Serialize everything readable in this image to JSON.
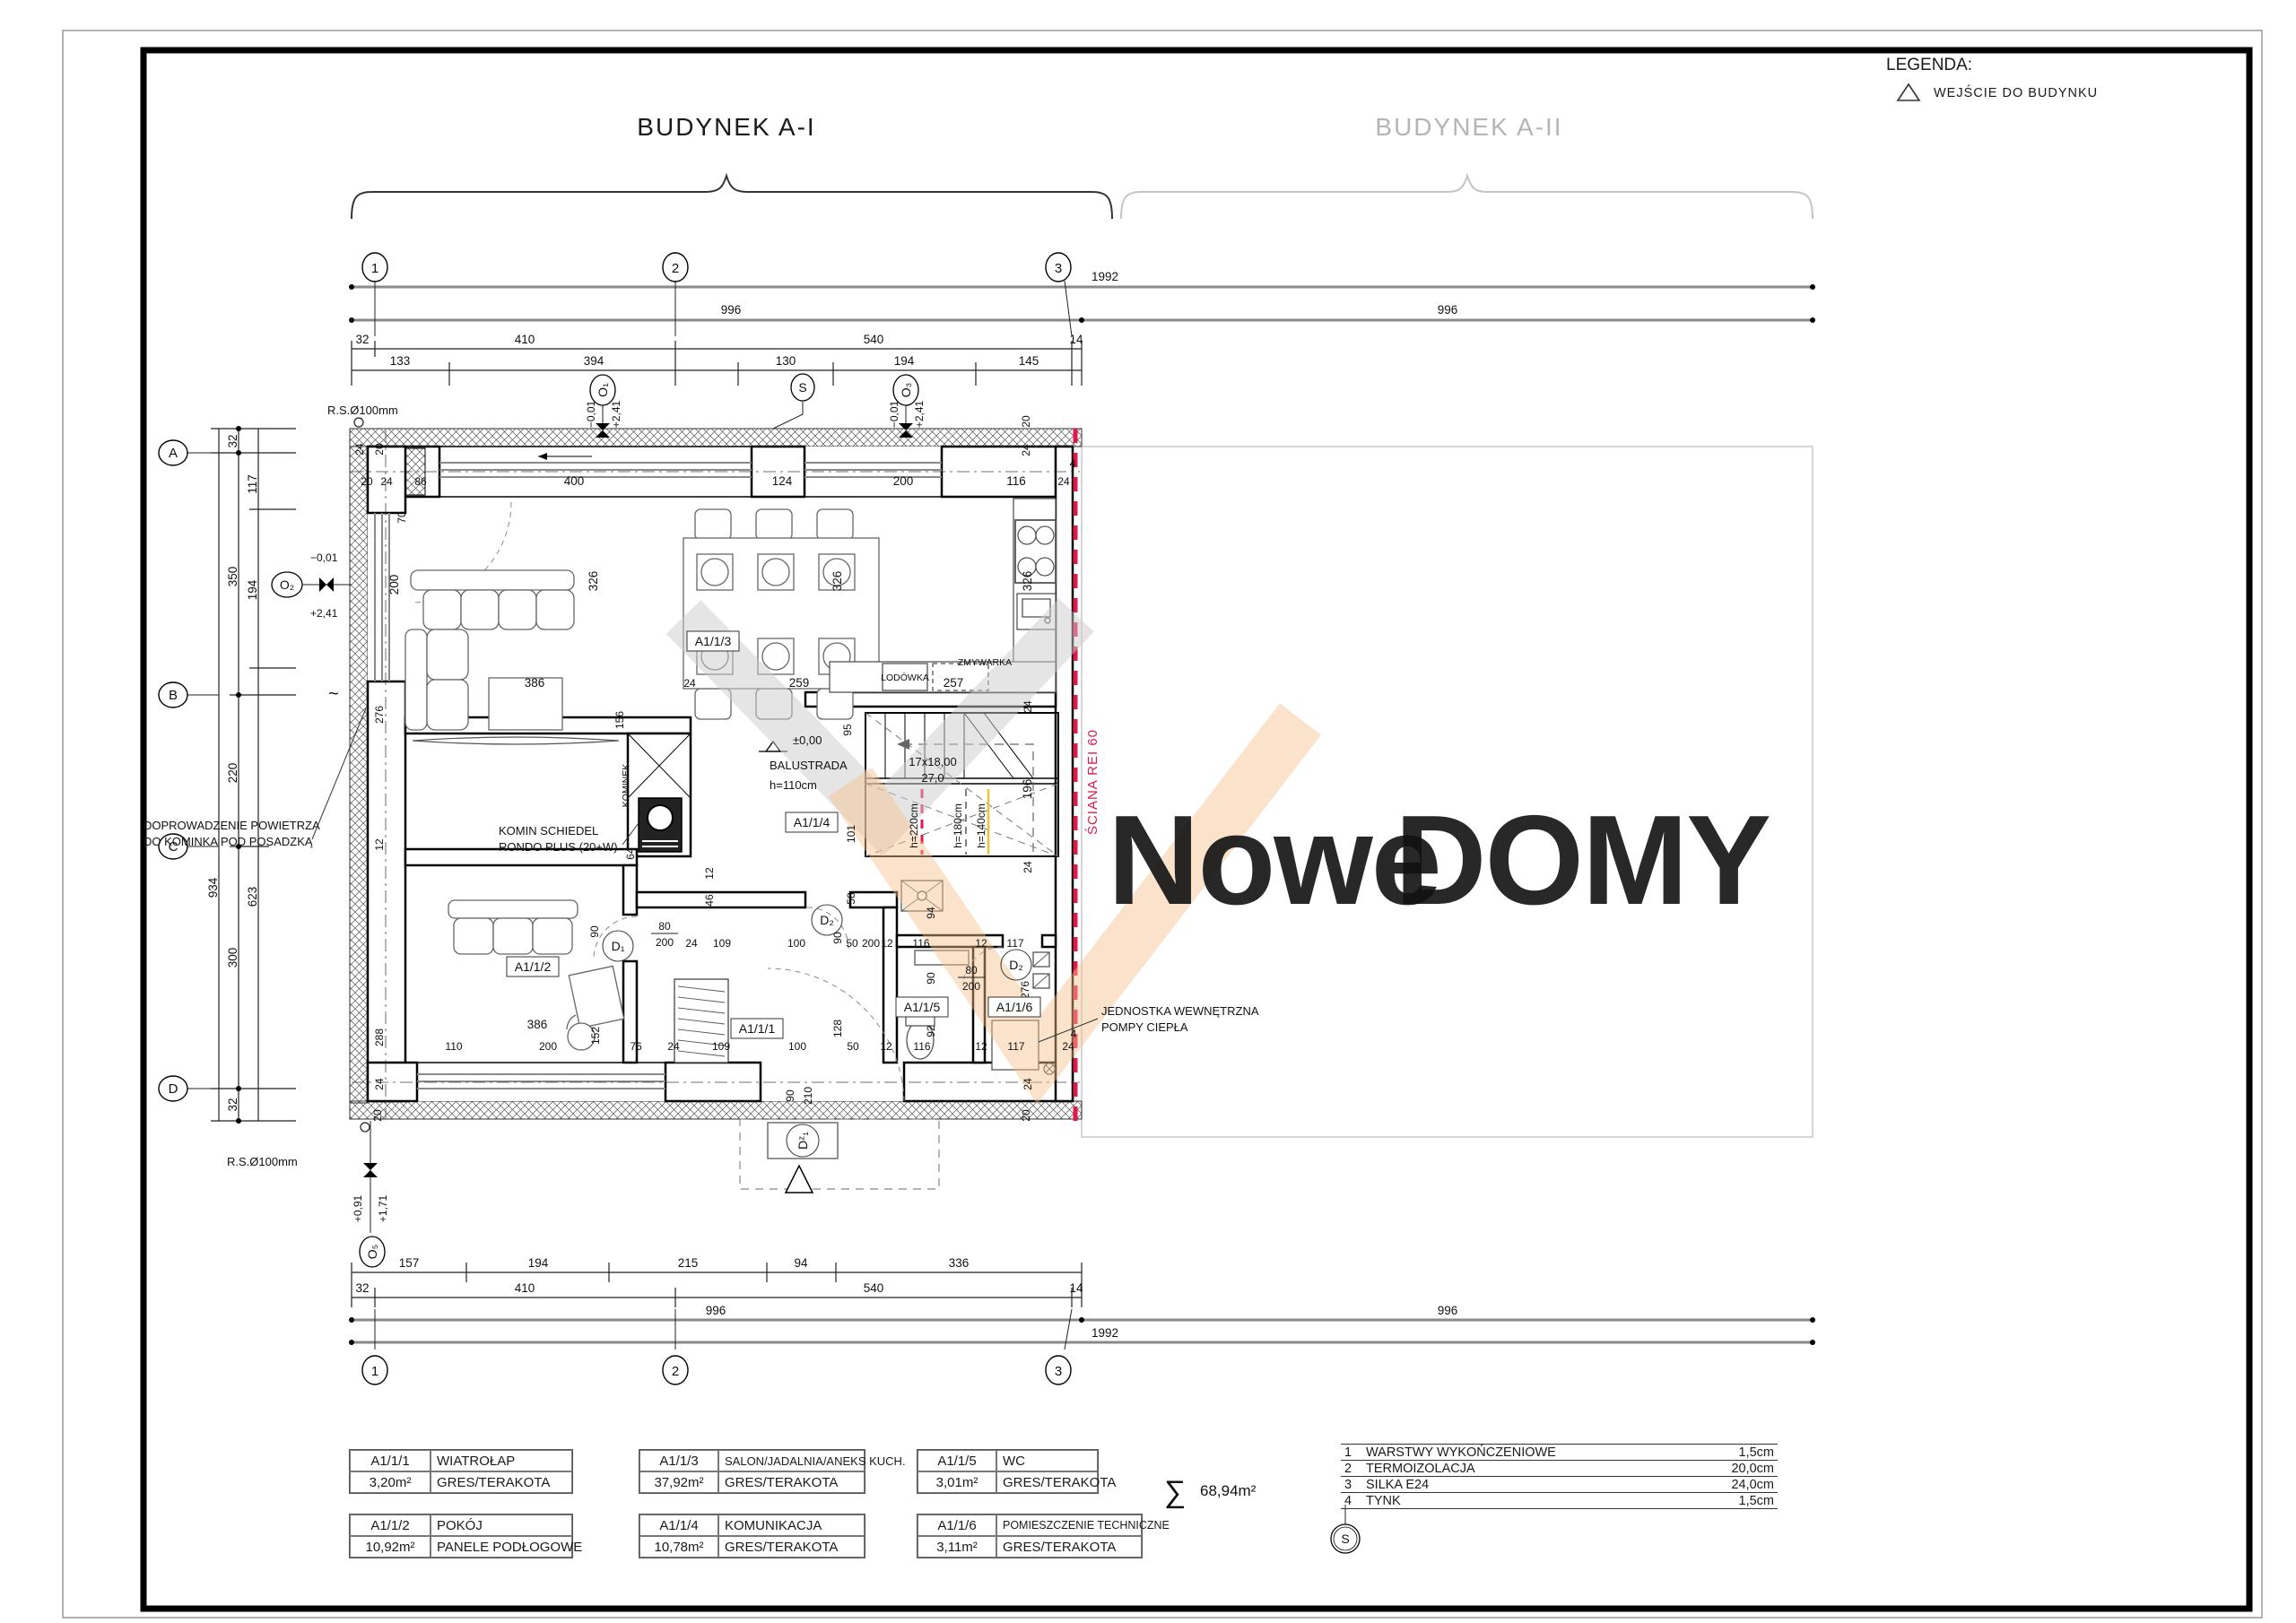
{
  "titles": {
    "left": "BUDYNEK A-I",
    "right": "BUDYNEK A-II"
  },
  "legend": {
    "title": "LEGENDA:",
    "entry": "WEJŚCIE DO BUDYNKU"
  },
  "watermark": {
    "gray": "Nowe",
    "orange": "DOMY"
  },
  "axes": {
    "c1": "1",
    "c2": "2",
    "c3": "3",
    "rA": "A",
    "rB": "B",
    "rC": "C",
    "rD": "D"
  },
  "dims": {
    "top": {
      "total": "1992",
      "left996": "996",
      "right996": "996",
      "r2": [
        "32",
        "410",
        "540",
        "14"
      ],
      "r3": [
        "133",
        "394",
        "130",
        "194",
        "145"
      ]
    },
    "bottom": {
      "r1": [
        "157",
        "194",
        "215",
        "94",
        "336"
      ],
      "r2": [
        "32",
        "410",
        "540",
        "14"
      ],
      "left996": "996",
      "right996": "996",
      "total": "1992"
    },
    "left": {
      "total": "934",
      "outer": [
        "32",
        "350",
        "220",
        "300",
        "32"
      ],
      "inner": [
        "117",
        "194",
        "623"
      ]
    },
    "sd": [
      "20",
      "24",
      "86",
      "70",
      "400",
      "124",
      "200",
      "116",
      "24",
      "4",
      "20",
      "24",
      "200",
      "326",
      "326",
      "326",
      "386",
      "24",
      "259",
      "257",
      "276",
      "156",
      "12",
      "64",
      "95",
      "101",
      "58",
      "24",
      "196",
      "24",
      "12",
      "46",
      "90",
      "80",
      "200",
      "24",
      "109",
      "100",
      "90",
      "50",
      "200",
      "12",
      "116",
      "12",
      "117",
      "94",
      "80",
      "200",
      "90",
      "276",
      "128",
      "92",
      "288",
      "386",
      "152",
      "110",
      "200",
      "76",
      "24",
      "109",
      "100",
      "50",
      "12",
      "116",
      "12",
      "117",
      "4",
      "24",
      "90",
      "210",
      "24",
      "20",
      "24",
      "20",
      "20",
      "24"
    ]
  },
  "markers": {
    "o1": "O₁",
    "o2": "O₂",
    "o3": "O₃",
    "o5": "O₅",
    "s": "S",
    "d1": "D₁",
    "d2": "D₂",
    "dz1": "Dᶻ₁"
  },
  "levels": {
    "m001": "−0,01",
    "p241": "+2,41",
    "p091": "+0,91",
    "p171": "+1,71",
    "zero": "±0,00"
  },
  "notes": {
    "rs": "R.S.Ø100mm",
    "komin1": "KOMIN SCHIEDEL",
    "komin2": "RONDO PLUS (20+W)",
    "kominek": "KOMINEK",
    "balustrada": "BALUSTRADA",
    "balustrada_h": "h=110cm",
    "stairs1": "17x18,00",
    "stairs2": "27,0",
    "h220": "h=220cm",
    "h180": "h=180cm",
    "h140": "h=140cm",
    "sciana": "ŚCIANA REI 60",
    "jednostka1": "JEDNOSTKA WEWNĘTRZNA",
    "jednostka2": "POMPY CIEPŁA",
    "dopr1": "DOPROWADZENIE POWIETRZA",
    "dopr2": "DO KOMINKA POD POSADZKĄ",
    "lodowka": "LODÓWKA",
    "zmywarka": "ZMYWARKA",
    "tilde": "~"
  },
  "room_labels": {
    "r1": "A1/1/1",
    "r2": "A1/1/2",
    "r3": "A1/1/3",
    "r4": "A1/1/4",
    "r5": "A1/1/5",
    "r6": "A1/1/6"
  },
  "rooms": [
    {
      "code": "A1/1/1",
      "name": "WIATROŁAP",
      "area": "3,20m²",
      "floor": "GRES/TERAKOTA"
    },
    {
      "code": "A1/1/2",
      "name": "POKÓJ",
      "area": "10,92m²",
      "floor": "PANELE PODŁOGOWE"
    },
    {
      "code": "A1/1/3",
      "name": "SALON/JADALNIA/ANEKS KUCH.",
      "area": "37,92m²",
      "floor": "GRES/TERAKOTA"
    },
    {
      "code": "A1/1/4",
      "name": "KOMUNIKACJA",
      "area": "10,78m²",
      "floor": "GRES/TERAKOTA"
    },
    {
      "code": "A1/1/5",
      "name": "WC",
      "area": "3,01m²",
      "floor": "GRES/TERAKOTA"
    },
    {
      "code": "A1/1/6",
      "name": "POMIESZCZENIE TECHNICZNE",
      "area": "3,11m²",
      "floor": "GRES/TERAKOTA"
    }
  ],
  "summary": {
    "sigma": "∑",
    "area": "68,94m²"
  },
  "layers": {
    "rows": [
      {
        "no": "1",
        "name": "WARSTWY WYKOŃCZENIOWE",
        "val": "1,5cm"
      },
      {
        "no": "2",
        "name": "TERMOIZOLACJA",
        "val": "20,0cm"
      },
      {
        "no": "3",
        "name": "SILKA E24",
        "val": "24,0cm"
      },
      {
        "no": "4",
        "name": "TYNK",
        "val": "1,5cm"
      }
    ],
    "marker": "S"
  },
  "colors": {
    "red": "#e0194d",
    "yellow": "#eec23a",
    "wm_gray": "#d9d9d9",
    "wm_orange": "#f9d0a0"
  }
}
